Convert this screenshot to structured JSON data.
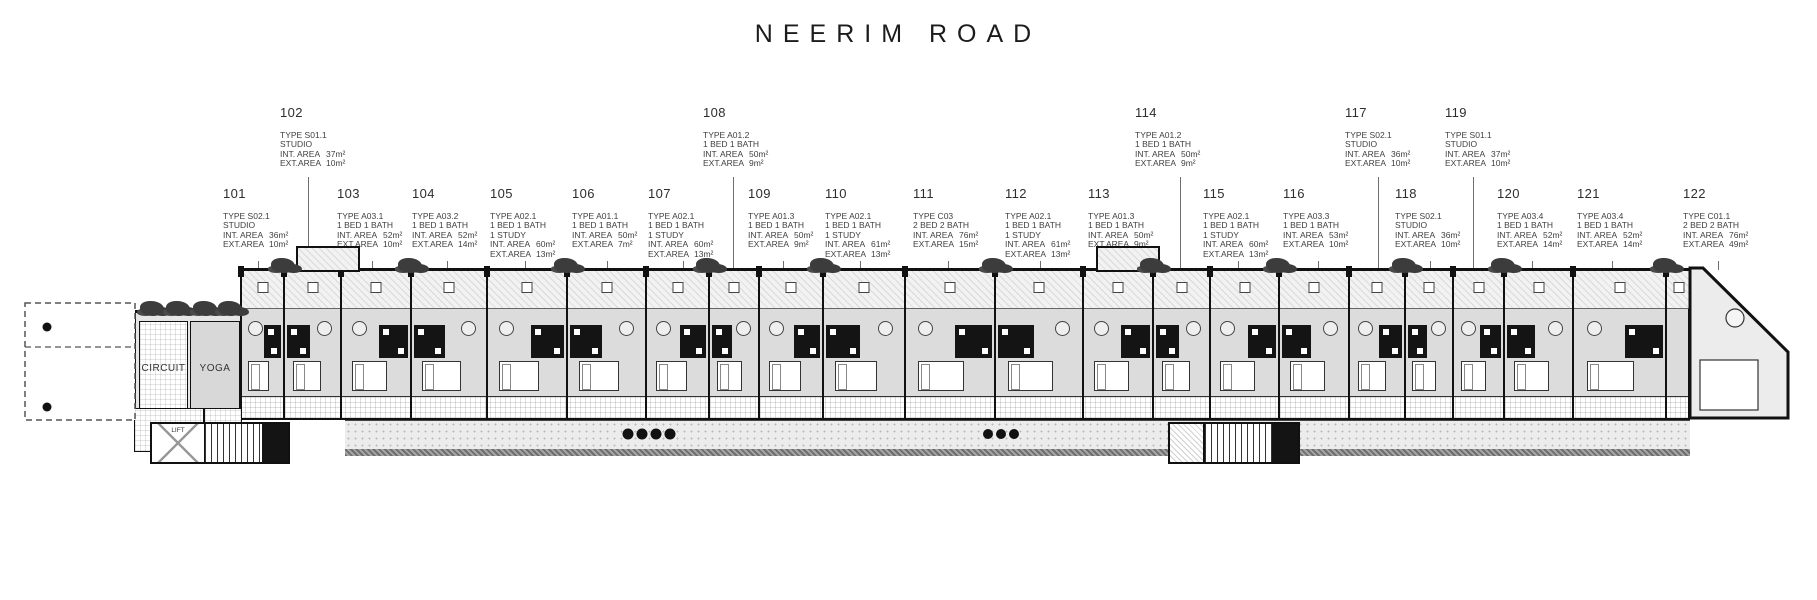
{
  "title": "NEERIM ROAD",
  "labels": {
    "int": "INT. AREA",
    "ext": "EXT.AREA"
  },
  "colors": {
    "ink": "#1a1a1a",
    "label_text": "#3f3f3f",
    "floor": "#dcdcdc",
    "pod": "#141414",
    "plant": "#3c3c3c",
    "terrace": "#ececec"
  },
  "plan_rooms": {
    "circuit": "CIRCUIT",
    "yoga": "YOGA",
    "spa": "SPA",
    "wc": "WC",
    "lift": "LIFT"
  },
  "units_top": [
    {
      "number": "102",
      "type": "TYPE S01.1",
      "desc": [
        "STUDIO"
      ],
      "int_area": "37m²",
      "ext_area": "10m²",
      "x": 280,
      "leader_x": 308
    },
    {
      "number": "108",
      "type": "TYPE A01.2",
      "desc": [
        "1 BED 1 BATH"
      ],
      "int_area": "50m²",
      "ext_area": "9m²",
      "x": 703,
      "leader_x": 733
    },
    {
      "number": "114",
      "type": "TYPE A01.2",
      "desc": [
        "1 BED 1 BATH"
      ],
      "int_area": "50m²",
      "ext_area": "9m²",
      "x": 1135,
      "leader_x": 1180
    },
    {
      "number": "117",
      "type": "TYPE S02.1",
      "desc": [
        "STUDIO"
      ],
      "int_area": "36m²",
      "ext_area": "10m²",
      "x": 1345,
      "leader_x": 1378
    },
    {
      "number": "119",
      "type": "TYPE S01.1",
      "desc": [
        "STUDIO"
      ],
      "int_area": "37m²",
      "ext_area": "10m²",
      "x": 1445,
      "leader_x": 1473
    }
  ],
  "units_bottom": [
    {
      "number": "101",
      "type": "TYPE S02.1",
      "desc": [
        "STUDIO"
      ],
      "int_area": "36m²",
      "ext_area": "10m²",
      "x": 223
    },
    {
      "number": "103",
      "type": "TYPE A03.1",
      "desc": [
        "1 BED 1 BATH"
      ],
      "int_area": "52m²",
      "ext_area": "10m²",
      "x": 337
    },
    {
      "number": "104",
      "type": "TYPE A03.2",
      "desc": [
        "1 BED 1 BATH"
      ],
      "int_area": "52m²",
      "ext_area": "14m²",
      "x": 412
    },
    {
      "number": "105",
      "type": "TYPE A02.1",
      "desc": [
        "1 BED 1 BATH",
        "1 STUDY"
      ],
      "int_area": "60m²",
      "ext_area": "13m²",
      "x": 490
    },
    {
      "number": "106",
      "type": "TYPE A01.1",
      "desc": [
        "1 BED 1 BATH"
      ],
      "int_area": "50m²",
      "ext_area": "7m²",
      "x": 572
    },
    {
      "number": "107",
      "type": "TYPE A02.1",
      "desc": [
        "1 BED 1 BATH",
        "1 STUDY"
      ],
      "int_area": "60m²",
      "ext_area": "13m²",
      "x": 648
    },
    {
      "number": "109",
      "type": "TYPE A01.3",
      "desc": [
        "1 BED 1 BATH"
      ],
      "int_area": "50m²",
      "ext_area": "9m²",
      "x": 748
    },
    {
      "number": "110",
      "type": "TYPE A02.1",
      "desc": [
        "1 BED 1 BATH",
        "1 STUDY"
      ],
      "int_area": "61m²",
      "ext_area": "13m²",
      "x": 825
    },
    {
      "number": "111",
      "type": "TYPE C03",
      "desc": [
        "2 BED 2 BATH"
      ],
      "int_area": "76m²",
      "ext_area": "15m²",
      "x": 913
    },
    {
      "number": "112",
      "type": "TYPE A02.1",
      "desc": [
        "1 BED 1 BATH",
        "1 STUDY"
      ],
      "int_area": "61m²",
      "ext_area": "13m²",
      "x": 1005
    },
    {
      "number": "113",
      "type": "TYPE A01.3",
      "desc": [
        "1 BED 1 BATH"
      ],
      "int_area": "50m²",
      "ext_area": "9m²",
      "x": 1088
    },
    {
      "number": "115",
      "type": "TYPE A02.1",
      "desc": [
        "1 BED 1 BATH",
        "1 STUDY"
      ],
      "int_area": "60m²",
      "ext_area": "13m²",
      "x": 1203
    },
    {
      "number": "116",
      "type": "TYPE A03.3",
      "desc": [
        "1 BED 1 BATH"
      ],
      "int_area": "53m²",
      "ext_area": "10m²",
      "x": 1283
    },
    {
      "number": "118",
      "type": "TYPE S02.1",
      "desc": [
        "STUDIO"
      ],
      "int_area": "36m²",
      "ext_area": "10m²",
      "x": 1395
    },
    {
      "number": "120",
      "type": "TYPE A03.4",
      "desc": [
        "1 BED 1 BATH"
      ],
      "int_area": "52m²",
      "ext_area": "14m²",
      "x": 1497
    },
    {
      "number": "121",
      "type": "TYPE A03.4",
      "desc": [
        "1 BED 1 BATH"
      ],
      "int_area": "52m²",
      "ext_area": "14m²",
      "x": 1577
    },
    {
      "number": "122",
      "type": "TYPE C01.1",
      "desc": [
        "2 BED 2 BATH"
      ],
      "int_area": "76m²",
      "ext_area": "49m²",
      "x": 1683
    }
  ]
}
